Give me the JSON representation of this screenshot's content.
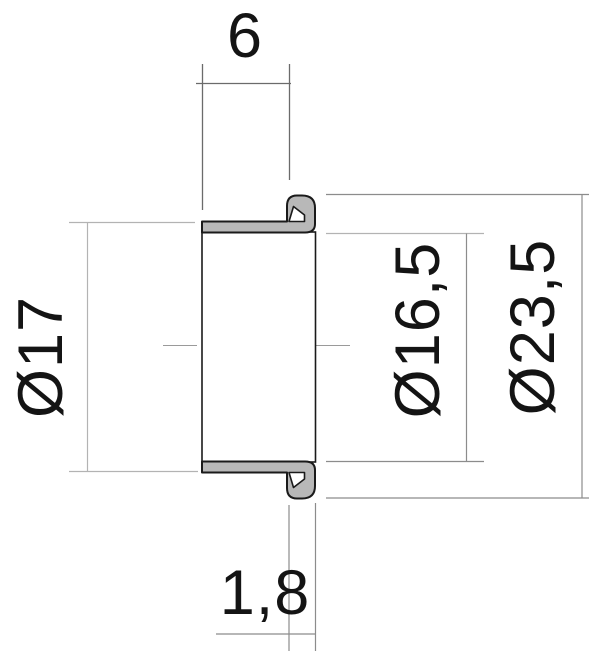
{
  "drawing": {
    "dimensions": {
      "width": {
        "label": "6"
      },
      "outer_diameter": {
        "label": "Ø17"
      },
      "inner_diameter": {
        "label": "Ø16,5"
      },
      "flange_diameter": {
        "label": "Ø23,5"
      },
      "lip_thickness": {
        "label": "1,8"
      }
    }
  },
  "colors": {
    "background": "#ffffff",
    "part-fill": "#b8b8b8",
    "part-outline": "#1a1a1a",
    "dimension-lines": "#8c8c8c",
    "dimension-lines-light": "#b3b3b3",
    "dimension-lines-dark": "#6b6b6b",
    "centerline": "#9a9a9a",
    "text": "#141414"
  }
}
